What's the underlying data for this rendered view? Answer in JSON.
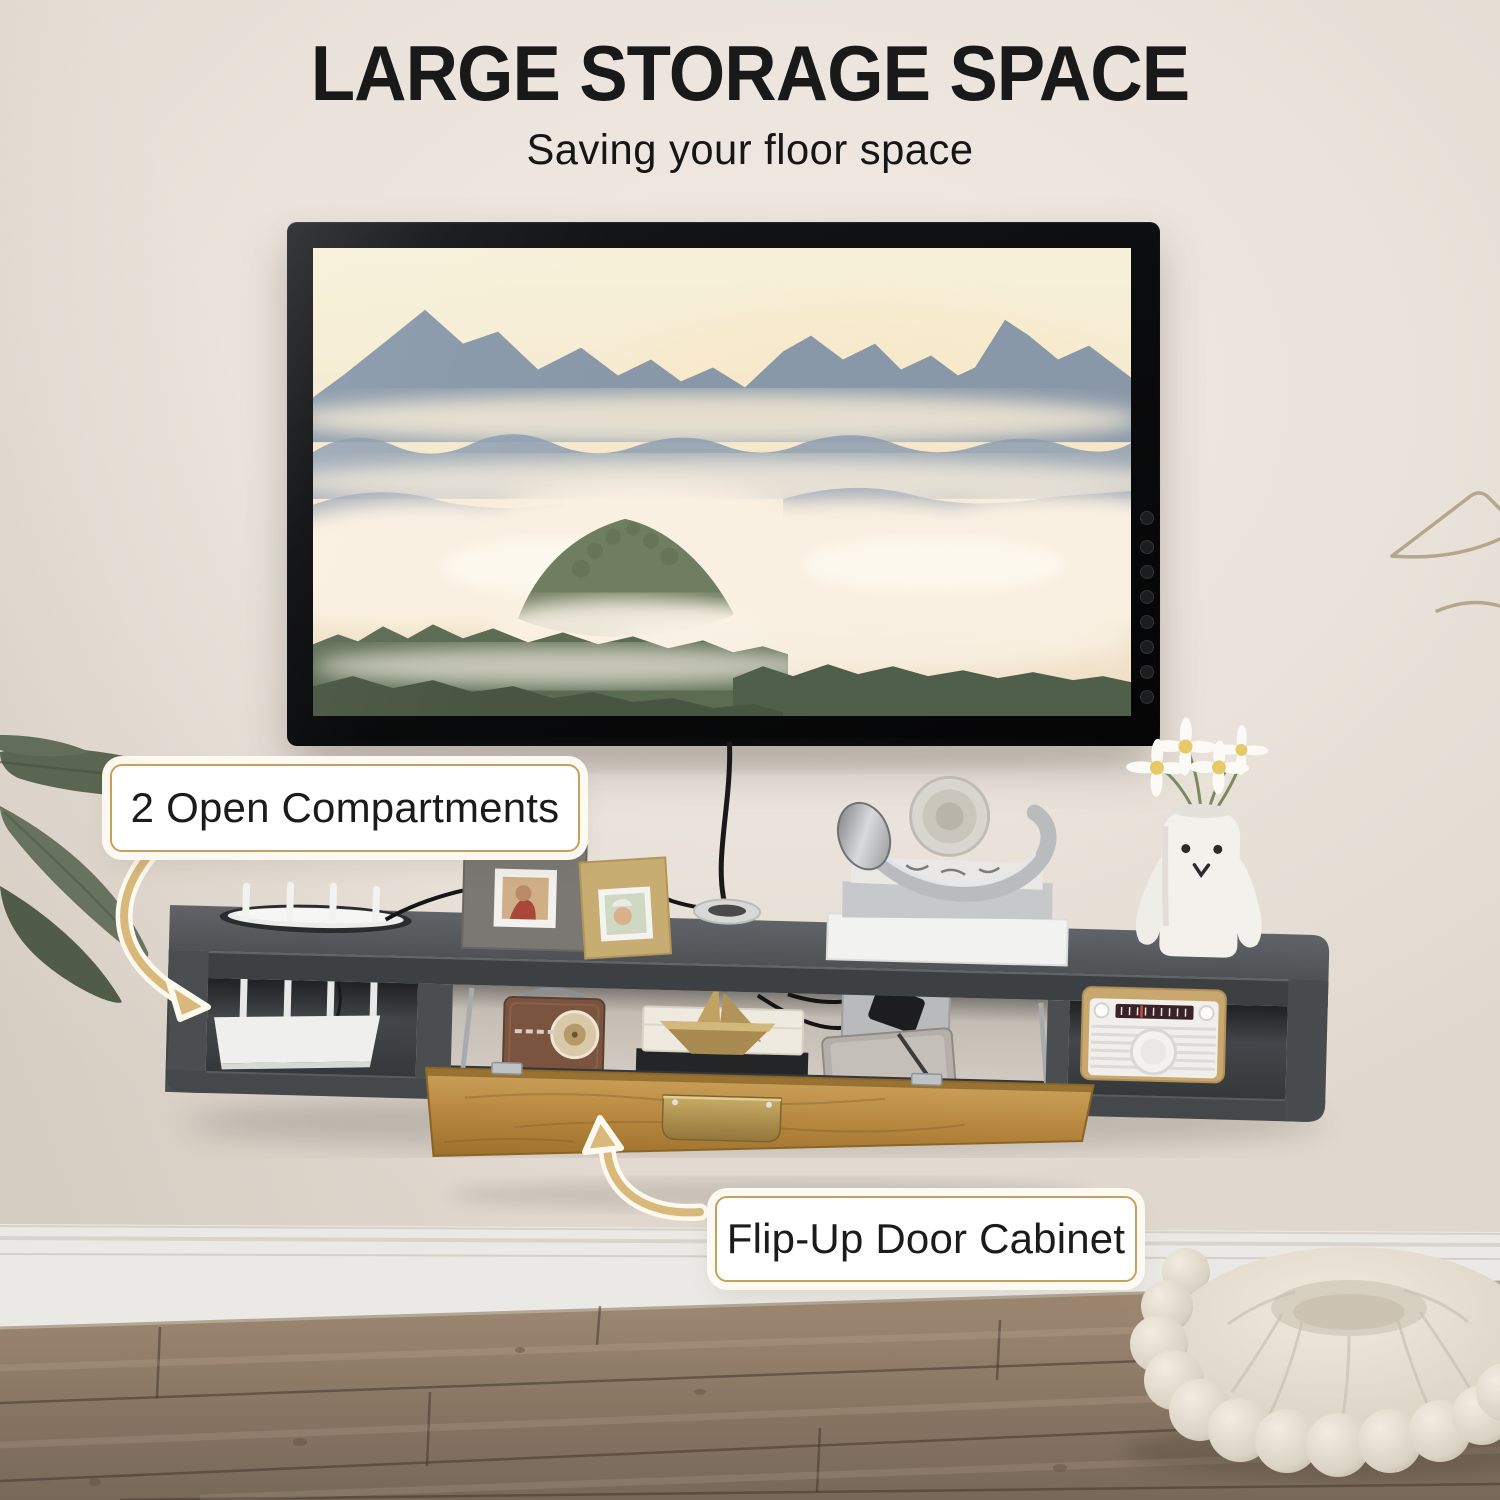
{
  "header": {
    "title": "LARGE STORAGE SPACE",
    "subtitle": "Saving your floor space"
  },
  "callouts": {
    "open_compartments": {
      "label": "2 Open Compartments"
    },
    "flip_up_door": {
      "label": "Flip-Up Door Cabinet"
    }
  },
  "colors": {
    "title_text": "#191919",
    "wall": "#ebe4dc",
    "accent_gold_border": "#c7a05e",
    "arrow_tan": "#d9b87c",
    "console_gray": "#4a4e51",
    "door_wood": "#b8873f",
    "floor_brown": "#8d7a67"
  }
}
